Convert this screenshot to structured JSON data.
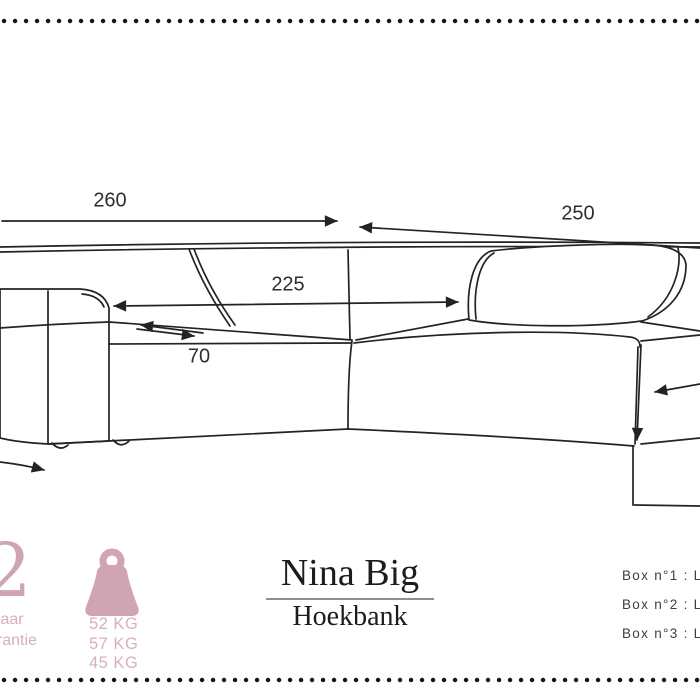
{
  "colors": {
    "accent_pink": "#cfa4b3",
    "text_pink": "#d7afbd",
    "line": "#232323"
  },
  "dimensions": {
    "back_width": "260",
    "chaise_width": "250",
    "inner_width": "225",
    "seat_depth": "70"
  },
  "title": {
    "name": "Nina Big",
    "subtitle": "Hoekbank"
  },
  "warranty": {
    "years": "2",
    "word1": "Jaar",
    "word2": "garantie"
  },
  "weights": [
    "52 KG",
    "57 KG",
    "45 KG"
  ],
  "boxes": [
    "Box n°1 : L 1",
    "Box n°2 : L 1",
    "Box n°3 : L 1"
  ]
}
